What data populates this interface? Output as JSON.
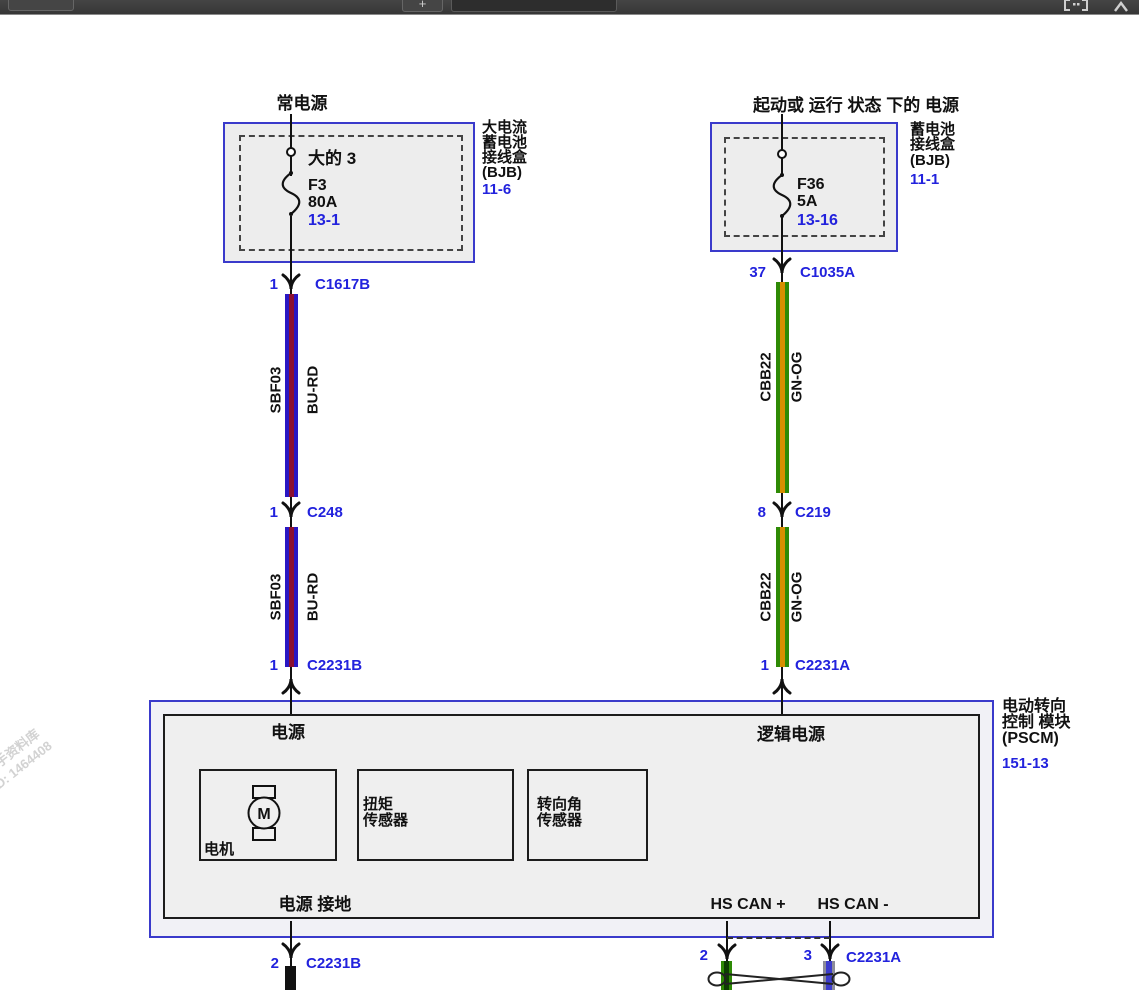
{
  "toolbar": {
    "add_button_label": "+",
    "search_value": ""
  },
  "watermark": {
    "line1": "汽修帮手资料库",
    "line2": "ID: 1464408"
  },
  "colors": {
    "connector_label_blue": "#2222dd",
    "box_border_blue": "#3a3acb",
    "wire_blue": "#2a17c3",
    "wire_red_stripe": "#8c1030",
    "wire_green": "#2e8a05",
    "wire_orange_stripe": "#d78f00",
    "wire_black": "#111111",
    "can_low_blue": "#3c3ccc",
    "can_low_gray": "#8c8c99"
  },
  "left_branch": {
    "header": "常电源",
    "box": {
      "inline_label": "大的 3",
      "fuse_name": "F3",
      "fuse_rating": "80A",
      "fuse_page": "13-1",
      "side_lines": [
        "大电流",
        "蓄电池",
        "接线盒",
        "(BJB)"
      ],
      "side_page": "11-6"
    },
    "wire": {
      "circuit": "SBF03",
      "color_code": "BU-RD"
    },
    "connectors": [
      {
        "pin": "1",
        "name": "C1617B"
      },
      {
        "pin": "1",
        "name": "C248"
      },
      {
        "pin": "1",
        "name": "C2231B"
      }
    ],
    "ground_connector": {
      "pin": "2",
      "name": "C2231B"
    }
  },
  "right_branch": {
    "header": "起动或 运行 状态 下的 电源",
    "box": {
      "fuse_name": "F36",
      "fuse_rating": "5A",
      "fuse_page": "13-16",
      "side_lines": [
        "蓄电池",
        "接线盒",
        "(BJB)"
      ],
      "side_page": "11-1"
    },
    "wire": {
      "circuit": "CBB22",
      "color_code": "GN-OG"
    },
    "connectors": [
      {
        "pin": "37",
        "name": "C1035A"
      },
      {
        "pin": "8",
        "name": "C219"
      },
      {
        "pin": "1",
        "name": "C2231A"
      }
    ],
    "can_connector": {
      "pin_high": "2",
      "pin_low": "3",
      "name": "C2231A"
    }
  },
  "pscm": {
    "power_in": "电源",
    "logic_power_in": "逻辑电源",
    "motor_symbol": "M",
    "motor_label": "电机",
    "torque_sensor_lines": [
      "扭矩",
      "传感器"
    ],
    "angle_sensor_lines": [
      "转向角",
      "传感器"
    ],
    "ground_label": "电源 接地",
    "can_high_label": "HS CAN +",
    "can_low_label": "HS CAN -",
    "side_lines": [
      "电动转向",
      "控制 模块",
      "(PSCM)"
    ],
    "side_page": "151-13"
  }
}
